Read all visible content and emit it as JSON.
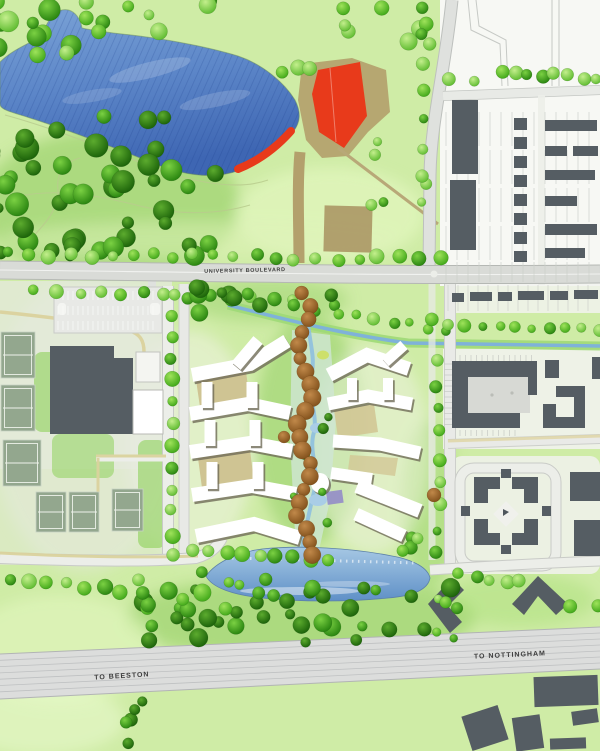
{
  "title": "Campus masterplan site map",
  "labels": {
    "university_boulevard": "UNIVERSITY BOULEVARD",
    "to_beeston": "TO BEESTON",
    "to_nottingham": "TO NOTTINGHAM"
  },
  "colors": {
    "grass-base": "#cfeca6",
    "grass-bright": "#7ccb40",
    "lake-top": "#7aa2d6",
    "lake-bottom": "#3e66b3",
    "pond-top": "#a6c8e4",
    "pond-bottom": "#5f90c7",
    "water-line": "#7fb2d9",
    "accent-red": "#e83a1b",
    "path-tan": "#b3a06c",
    "path-khaki": "#dbd29e",
    "building-white": "#ffffff",
    "building-shadow": "#6f6c58",
    "building-dark": "#555d63",
    "road-fill": "#d9dbd7",
    "road-edge": "#b5b8b4",
    "white-road": "#eceee9",
    "rail-fill": "#dcdddc",
    "court-green": "#93a78e",
    "tree-brown": "#8a5a28",
    "label-ink": "#3c3c3c"
  }
}
